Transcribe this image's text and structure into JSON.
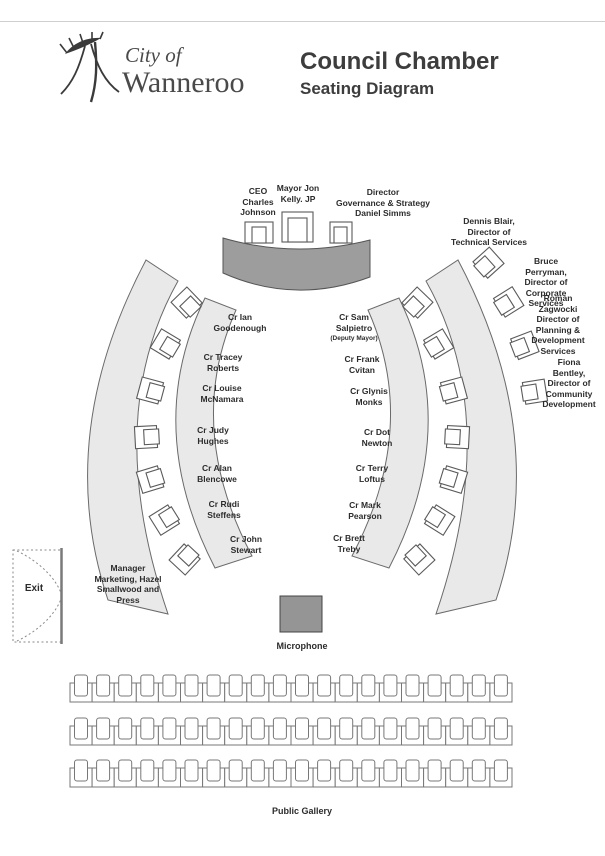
{
  "header": {
    "logo_line1": "City of",
    "logo_line2": "Wanneroo",
    "title": "Council Chamber",
    "subtitle": "Seating Diagram"
  },
  "dais": {
    "seats": [
      {
        "label": "CEO\nCharles\nJohnson"
      },
      {
        "label": "Mayor Jon\nKelly. JP"
      },
      {
        "label": "Director\nGovernance & Strategy\nDaniel Simms"
      }
    ]
  },
  "directors": [
    {
      "label": "Dennis Blair,\nDirector of\nTechnical Services"
    },
    {
      "label": "Bruce Perryman,\nDirector of\nCorporate Services"
    },
    {
      "label": "Roman Zagwocki\nDirector of\nPlanning &\nDevelopment\nServices"
    },
    {
      "label": "Fiona Bentley,\nDirector of\nCommunity\nDevelopment"
    }
  ],
  "councillors": {
    "left": [
      {
        "label": "Cr Ian\nGoodenough"
      },
      {
        "label": "Cr Tracey\nRoberts"
      },
      {
        "label": "Cr Louise\nMcNamara"
      },
      {
        "label": "Cr Judy\nHughes"
      },
      {
        "label": "Cr Alan\nBlencowe"
      },
      {
        "label": "Cr Rudi\nSteffens"
      },
      {
        "label": "Cr John\nStewart"
      }
    ],
    "right": [
      {
        "label": "Cr Sam\nSalpietro",
        "note": "(Deputy Mayor)"
      },
      {
        "label": "Cr Frank\nCvitan"
      },
      {
        "label": "Cr Glynis\nMonks"
      },
      {
        "label": "Cr Dot\nNewton"
      },
      {
        "label": "Cr Terry\nLoftus"
      },
      {
        "label": "Cr Mark\nPearson"
      },
      {
        "label": "Cr Brett\nTreby"
      }
    ]
  },
  "press": {
    "label": "Manager\nMarketing, Hazel\nSmallwood and\nPress"
  },
  "exit": {
    "label": "Exit"
  },
  "microphone": {
    "label": "Microphone"
  },
  "public_gallery": {
    "label": "Public Gallery",
    "rows": 3,
    "seats_per_row": 20
  },
  "colors": {
    "band_fill": "#e9e9e9",
    "band_stroke": "#6a6a6a",
    "chair_stroke": "#5a5a5a",
    "dais_fill": "#9d9d9d",
    "dais_stroke": "#555555",
    "mic_fill": "#959595",
    "text": "#2c2c2c"
  }
}
